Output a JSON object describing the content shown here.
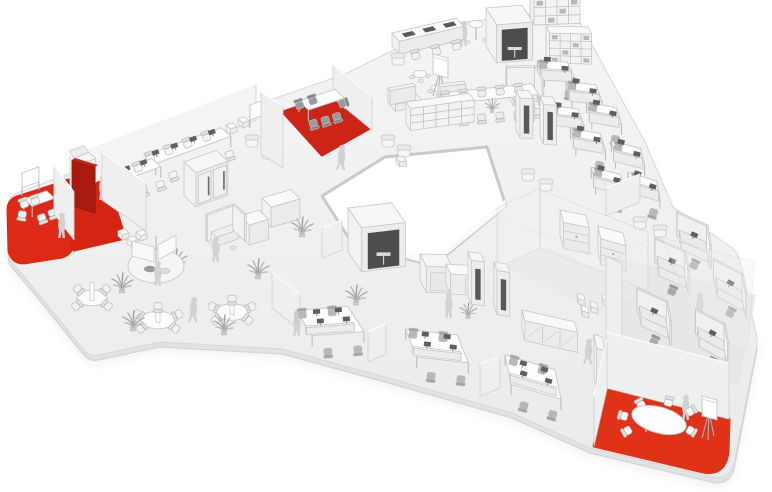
{
  "meta": {
    "description": "Isometric 3D rendering of a three-wing office floor plan in white and grey with red highlighted meeting zones",
    "canvas": {
      "w": 772,
      "h": 492
    }
  },
  "palette": {
    "background": "#ffffff",
    "floor_top": "#f4f4f4",
    "floor_bottom": "#ebebeb",
    "floor_edge": "#d8d8d8",
    "slab": "#e2e2e2",
    "shadow": "#d9d9d9",
    "courtyard_rim": "#c9c9c9",
    "wall": "#efefef",
    "wall_stroke": "#d2d2d2",
    "glass": "#eef2f5",
    "furniture_top": "#fbfbfb",
    "furniture_front": "#ececec",
    "furniture_stroke": "#c7c7c7",
    "accent_red": "#dd2a16",
    "accent_red_dark": "#a81c10",
    "dark_detail": "#4d4d4d",
    "chair_dark": "#9a9a9a",
    "person": "#d2d2d2",
    "plant": "#aaaaaa",
    "mat_grey": "#e7e7e7"
  },
  "floor": {
    "outer_path": "M 8,206 Q 8,196 20,192 L 250,107 L 345,74 L 432,31 Q 441,26 452,24 L 556,10 Q 572,8 579,21 L 645,142 L 673,207 L 731,247 Q 738,252 740,261 L 757,338 L 757,345 L 734,464 Q 729,481 711,477 L 590,448 L 512,413 L 385,377 L 282,349 L 160,342 L 98,355 Q 89,357 83,349 L 32,286 L 10,260 Q 8,256 8,248 Z",
    "courtyard": [
      [
        322,
        196
      ],
      [
        385,
        157
      ],
      [
        487,
        147
      ],
      [
        506,
        206
      ],
      [
        433,
        266
      ],
      [
        352,
        243
      ]
    ]
  },
  "mats": [
    {
      "name": "highlight-zone-left-carpet",
      "interactable": true,
      "fill": "#dd2a16",
      "path": "M 54,185 L 72,241 Q 74,253 62,257 L 30,262 Q 13,266 9,251 L 8,210 Q 8,199 20,196 Z"
    },
    {
      "name": "highlight-zone-left-room",
      "interactable": true,
      "fill": "#d42512",
      "pts": [
        [
          56,
          183
        ],
        [
          104,
          172
        ],
        [
          125,
          238
        ],
        [
          74,
          250
        ]
      ]
    },
    {
      "name": "highlight-zone-meeting-room",
      "interactable": true,
      "fill": "#cc2517",
      "pts": [
        [
          283,
          112
        ],
        [
          332,
          95
        ],
        [
          370,
          128
        ],
        [
          322,
          155
        ]
      ]
    },
    {
      "name": "glass-room-floor",
      "interactable": false,
      "fill": "#e9e9e9",
      "pts": [
        [
          505,
          266
        ],
        [
          545,
          248
        ],
        [
          650,
          290
        ],
        [
          610,
          312
        ]
      ]
    },
    {
      "name": "cubicle-zone-floor",
      "interactable": false,
      "fill": "#e7e7e7",
      "pts": [
        [
          628,
          260
        ],
        [
          754,
          296
        ],
        [
          738,
          384
        ],
        [
          622,
          346
        ]
      ]
    },
    {
      "name": "highlight-zone-bottom-right",
      "interactable": true,
      "fill": "#e03218",
      "path": "M 606,388 L 729,419 L 728,452 Q 725,478 699,471 L 594,446 Z"
    }
  ],
  "items": [
    {
      "t": "wall",
      "name": "back-wall-left-wing",
      "x1": 70,
      "y1": 192,
      "x2": 256,
      "y2": 120,
      "h": 36,
      "z": 100,
      "fill": "#f4f4f4"
    },
    {
      "t": "wall",
      "name": "courtyard-parapet",
      "x1": 506,
      "y1": 207,
      "x2": 433,
      "y2": 266,
      "h": 7,
      "z": 208,
      "fill": "#fafafa"
    },
    {
      "t": "wall",
      "name": "courtyard-parapet",
      "x1": 433,
      "y1": 266,
      "x2": 352,
      "y2": 243,
      "h": 7,
      "z": 209,
      "fill": "#fafafa"
    },
    {
      "t": "whiteboard",
      "name": "whiteboard",
      "x": 22,
      "y": 196
    },
    {
      "t": "table",
      "name": "meeting-table-left",
      "x": 24,
      "y": 210,
      "w": 24,
      "d": 11,
      "cf": "#f4f4f4",
      "chairs": [
        [
          -5,
          4,
          210
        ],
        [
          5,
          -6,
          0
        ],
        [
          16,
          -5,
          0
        ],
        [
          7,
          15,
          180
        ],
        [
          19,
          14,
          180
        ]
      ]
    },
    {
      "t": "person",
      "x": 62,
      "y": 238,
      "pose": "stand"
    },
    {
      "t": "wall",
      "name": "partition-wall",
      "x1": 54,
      "y1": 214,
      "x2": 74,
      "y2": 240,
      "h": 48
    },
    {
      "t": "copier",
      "name": "printer-station",
      "x": 74,
      "y": 182
    },
    {
      "t": "redCabinet",
      "name": "red-storage-wall",
      "x1": 72,
      "y1": 206,
      "x2": 95,
      "y2": 213,
      "h": 46
    },
    {
      "t": "person",
      "x": 103,
      "y": 200,
      "pose": "stand"
    },
    {
      "t": "wall",
      "name": "partition-wall",
      "x1": 102,
      "y1": 200,
      "x2": 146,
      "y2": 231,
      "h": 48
    },
    {
      "t": "deskRow",
      "name": "training-desk-row",
      "x": 146,
      "y": 166,
      "len": 80,
      "d": 13,
      "n": 4
    },
    {
      "t": "deskRow",
      "name": "training-desk-row",
      "x": 118,
      "y": 182,
      "len": 36,
      "d": 12,
      "n": 2
    },
    {
      "t": "doubleBooth",
      "name": "focus-booth-double",
      "x": 184,
      "y": 196
    },
    {
      "t": "armchair",
      "x": 252,
      "y": 146
    },
    {
      "t": "armchair",
      "x": 268,
      "y": 158
    },
    {
      "t": "pouf",
      "x": 226,
      "y": 130
    },
    {
      "t": "pouf",
      "x": 238,
      "y": 124
    },
    {
      "t": "counter",
      "name": "kitchen-counter",
      "x": 262,
      "y": 218,
      "w": 30
    },
    {
      "t": "whiteboard",
      "name": "whiteboard",
      "x": 250,
      "y": 128
    },
    {
      "t": "wall",
      "name": "meeting-room-wall-left",
      "x1": 261,
      "y1": 154,
      "x2": 283,
      "y2": 168,
      "h": 62
    },
    {
      "t": "wall",
      "name": "meeting-room-wall-right",
      "x1": 333,
      "y1": 98,
      "x2": 372,
      "y2": 130,
      "h": 33
    },
    {
      "t": "table",
      "name": "conference-table",
      "x": 299,
      "y": 112,
      "w": 38,
      "d": 13,
      "cf": "#9a9a9a",
      "chairs": [
        [
          6,
          -7,
          0
        ],
        [
          20,
          -7,
          0
        ],
        [
          2,
          17,
          180
        ],
        [
          14,
          18,
          180
        ],
        [
          26,
          18,
          180
        ],
        [
          41,
          6,
          90
        ]
      ]
    },
    {
      "t": "person",
      "x": 341,
      "y": 170,
      "pose": "walk"
    },
    {
      "t": "flipchart",
      "x": 437,
      "y": 96
    },
    {
      "t": "confTable",
      "name": "project-table",
      "x": 440,
      "y": 104,
      "len": 92,
      "d": 13,
      "n": 5
    },
    {
      "t": "armchair",
      "x": 388,
      "y": 146
    },
    {
      "t": "armchair",
      "x": 404,
      "y": 156
    },
    {
      "t": "pouf",
      "x": 396,
      "y": 162
    },
    {
      "t": "boothBench",
      "name": "cafe-booth-bench",
      "x": 392,
      "y": 46
    },
    {
      "t": "person",
      "x": 453,
      "y": 44,
      "pose": "stand"
    },
    {
      "t": "person",
      "x": 464,
      "y": 46,
      "pose": "stand"
    },
    {
      "t": "highTable",
      "x": 476,
      "y": 40
    },
    {
      "t": "armchair",
      "x": 398,
      "y": 64
    },
    {
      "t": "roundStools",
      "x": 420,
      "y": 74
    },
    {
      "t": "roundStools",
      "x": 438,
      "y": 88
    },
    {
      "t": "sofa",
      "x": 388,
      "y": 102
    },
    {
      "t": "sofa",
      "x": 438,
      "y": 98
    },
    {
      "t": "shelf",
      "name": "open-shelf",
      "x": 406,
      "y": 124,
      "w": 64,
      "h": 22,
      "cols": 5,
      "rows": 3
    },
    {
      "t": "shelf",
      "name": "library-shelf",
      "x": 530,
      "y": 18,
      "w": 46,
      "h": 26,
      "cols": 4,
      "rows": 3,
      "dark": true
    },
    {
      "t": "shelf",
      "name": "library-shelf",
      "x": 546,
      "y": 56,
      "w": 42,
      "h": 30,
      "cols": 4,
      "rows": 4,
      "dark": true
    },
    {
      "t": "meetingBox",
      "name": "meeting-cube",
      "x": 486,
      "y": 46,
      "w": 36,
      "d": 20,
      "h": 38,
      "dark": true
    },
    {
      "t": "uCubicle",
      "name": "study-carrel",
      "x": 506,
      "y": 92
    },
    {
      "t": "person",
      "x": 532,
      "y": 122,
      "pose": "stand"
    },
    {
      "t": "phoneBooth",
      "x": 516,
      "y": 130
    },
    {
      "t": "phoneBooth",
      "x": 540,
      "y": 136
    },
    {
      "t": "armchair",
      "x": 528,
      "y": 180
    },
    {
      "t": "armchair",
      "x": 546,
      "y": 190
    },
    {
      "t": "plant",
      "x": 492,
      "y": 112,
      "s": 0.7
    },
    {
      "t": "deskPair",
      "x": 556,
      "y": 80
    },
    {
      "t": "deskPair",
      "x": 584,
      "y": 102
    },
    {
      "t": "deskPair",
      "x": 566,
      "y": 126
    },
    {
      "t": "deskPair",
      "x": 604,
      "y": 124
    },
    {
      "t": "deskPair",
      "x": 588,
      "y": 150
    },
    {
      "t": "deskPair",
      "x": 628,
      "y": 164
    },
    {
      "t": "deskPair",
      "x": 608,
      "y": 190
    },
    {
      "t": "deskPair",
      "x": 644,
      "y": 196
    },
    {
      "t": "wall",
      "name": "end-panel",
      "x1": 606,
      "y1": 216,
      "x2": 640,
      "y2": 202,
      "h": 28
    },
    {
      "t": "armchair",
      "x": 640,
      "y": 228
    },
    {
      "t": "armchair",
      "x": 660,
      "y": 236
    },
    {
      "t": "glassQuad",
      "name": "glass-partition",
      "pts": [
        [
          662,
          238
        ],
        [
          754,
          262
        ],
        [
          748,
          352
        ],
        [
          700,
          330
        ]
      ],
      "z": 332,
      "op": 0.3
    },
    {
      "t": "glass",
      "name": "glass-wall",
      "x1": 497,
      "y1": 268,
      "x2": 540,
      "y2": 248,
      "h": 60,
      "z": 235
    },
    {
      "t": "glass",
      "name": "glass-wall",
      "x1": 540,
      "y1": 248,
      "x2": 648,
      "y2": 290,
      "h": 58,
      "z": 240
    },
    {
      "t": "credenza",
      "x": 560,
      "y": 236
    },
    {
      "t": "credenza",
      "x": 598,
      "y": 252
    },
    {
      "t": "pouf",
      "x": 577,
      "y": 298
    },
    {
      "t": "pouf",
      "x": 590,
      "y": 306
    },
    {
      "t": "pouf",
      "x": 602,
      "y": 299
    },
    {
      "t": "pouf",
      "x": 581,
      "y": 310
    },
    {
      "t": "glass",
      "name": "glass-wall-front",
      "x1": 497,
      "y1": 268,
      "x2": 610,
      "y2": 314,
      "h": 52,
      "z": 316,
      "op": 0.22
    },
    {
      "t": "glass",
      "name": "glass-wall-front",
      "x1": 610,
      "y1": 314,
      "x2": 648,
      "y2": 292,
      "h": 52,
      "z": 318,
      "op": 0.22
    },
    {
      "t": "sideboard",
      "name": "sideboard",
      "x": 522,
      "y": 330,
      "w": 54,
      "hatch": true
    },
    {
      "t": "wall",
      "name": "panel",
      "x1": 322,
      "y1": 258,
      "x2": 342,
      "y2": 250,
      "h": 30
    },
    {
      "t": "meetingBox",
      "name": "meeting-cube",
      "x": 348,
      "y": 252,
      "w": 44,
      "d": 24,
      "h": 44,
      "dark": true
    },
    {
      "t": "booth",
      "name": "high-back-booth",
      "x": 420,
      "y": 280
    },
    {
      "t": "sideboard",
      "name": "sideboard",
      "x": 446,
      "y": 284,
      "w": 30
    },
    {
      "t": "plant",
      "x": 468,
      "y": 318,
      "s": 0.8
    },
    {
      "t": "phoneBooth",
      "x": 468,
      "y": 296,
      "h": 44
    },
    {
      "t": "phoneBooth",
      "x": 494,
      "y": 306,
      "h": 44
    },
    {
      "t": "person",
      "x": 449,
      "y": 318,
      "pose": "stand"
    },
    {
      "t": "deskCluster",
      "x": 330,
      "y": 332
    },
    {
      "t": "deskCluster",
      "x": 437,
      "y": 357
    },
    {
      "t": "deskCluster",
      "x": 533,
      "y": 388
    },
    {
      "t": "wall",
      "name": "panel",
      "x1": 368,
      "y1": 362,
      "x2": 386,
      "y2": 354,
      "h": 30
    },
    {
      "t": "wall",
      "name": "panel",
      "x1": 480,
      "y1": 396,
      "x2": 500,
      "y2": 388,
      "h": 32
    },
    {
      "t": "person",
      "x": 588,
      "y": 364,
      "pose": "walk"
    },
    {
      "t": "flowerPod",
      "name": "pod-workstation",
      "x": 156,
      "y": 266
    },
    {
      "t": "uCubicle",
      "name": "study-carrel",
      "x": 206,
      "y": 240
    },
    {
      "t": "person",
      "x": 216,
      "y": 262,
      "pose": "stand"
    },
    {
      "t": "counter",
      "name": "standing-desk",
      "x": 240,
      "y": 236,
      "w": 20
    },
    {
      "t": "pouf",
      "x": 118,
      "y": 236
    },
    {
      "t": "pouf",
      "x": 127,
      "y": 243
    },
    {
      "t": "pouf",
      "x": 136,
      "y": 237
    },
    {
      "t": "roundSplit",
      "x": 92,
      "y": 298,
      "r": 15,
      "n": 4
    },
    {
      "t": "roundSplit",
      "x": 158,
      "y": 320,
      "r": 17,
      "n": 5
    },
    {
      "t": "roundSplit",
      "x": 232,
      "y": 312,
      "r": 16,
      "n": 5
    },
    {
      "t": "plant",
      "x": 122,
      "y": 292
    },
    {
      "t": "plant",
      "x": 176,
      "y": 268
    },
    {
      "t": "plant",
      "x": 224,
      "y": 334
    },
    {
      "t": "plant",
      "x": 258,
      "y": 278
    },
    {
      "t": "plant",
      "x": 302,
      "y": 236
    },
    {
      "t": "plant",
      "x": 133,
      "y": 330
    },
    {
      "t": "plant",
      "x": 356,
      "y": 304
    },
    {
      "t": "person",
      "x": 193,
      "y": 322,
      "pose": "walk"
    },
    {
      "t": "wall",
      "name": "freestanding-panel",
      "x1": 272,
      "y1": 308,
      "x2": 300,
      "y2": 330,
      "h": 36
    },
    {
      "t": "person",
      "x": 297,
      "y": 336,
      "pose": "stand"
    },
    {
      "t": "person",
      "x": 158,
      "y": 286,
      "pose": "stand"
    },
    {
      "t": "wallQuad",
      "name": "wall",
      "pts": [
        [
          606,
          256
        ],
        [
          622,
          264
        ],
        [
          622,
          352
        ],
        [
          606,
          344
        ]
      ],
      "z": 330
    },
    {
      "t": "cubicle",
      "x": 694,
      "y": 252
    },
    {
      "t": "cubicle",
      "x": 672,
      "y": 278
    },
    {
      "t": "cubicle",
      "x": 730,
      "y": 300
    },
    {
      "t": "cubicle",
      "x": 654,
      "y": 328
    },
    {
      "t": "cubicle",
      "x": 712,
      "y": 350
    },
    {
      "t": "person",
      "x": 700,
      "y": 318,
      "pose": "stand"
    },
    {
      "t": "wall",
      "name": "meeting-area-back-wall",
      "x1": 606,
      "y1": 388,
      "x2": 729,
      "y2": 419,
      "h": 56,
      "z": 403,
      "fill": "#eef0f0"
    },
    {
      "t": "wall",
      "name": "meeting-area-side-wall",
      "x1": 594,
      "y1": 446,
      "x2": 607,
      "y2": 389,
      "h": 50,
      "z": 417
    },
    {
      "t": "wardrobe",
      "x": 594,
      "y": 376
    },
    {
      "t": "ovalTable",
      "name": "oval-meeting-table",
      "x": 659,
      "y": 429
    },
    {
      "t": "person",
      "x": 686,
      "y": 420,
      "pose": "stand"
    },
    {
      "t": "flipchart",
      "x": 706,
      "y": 438
    }
  ]
}
